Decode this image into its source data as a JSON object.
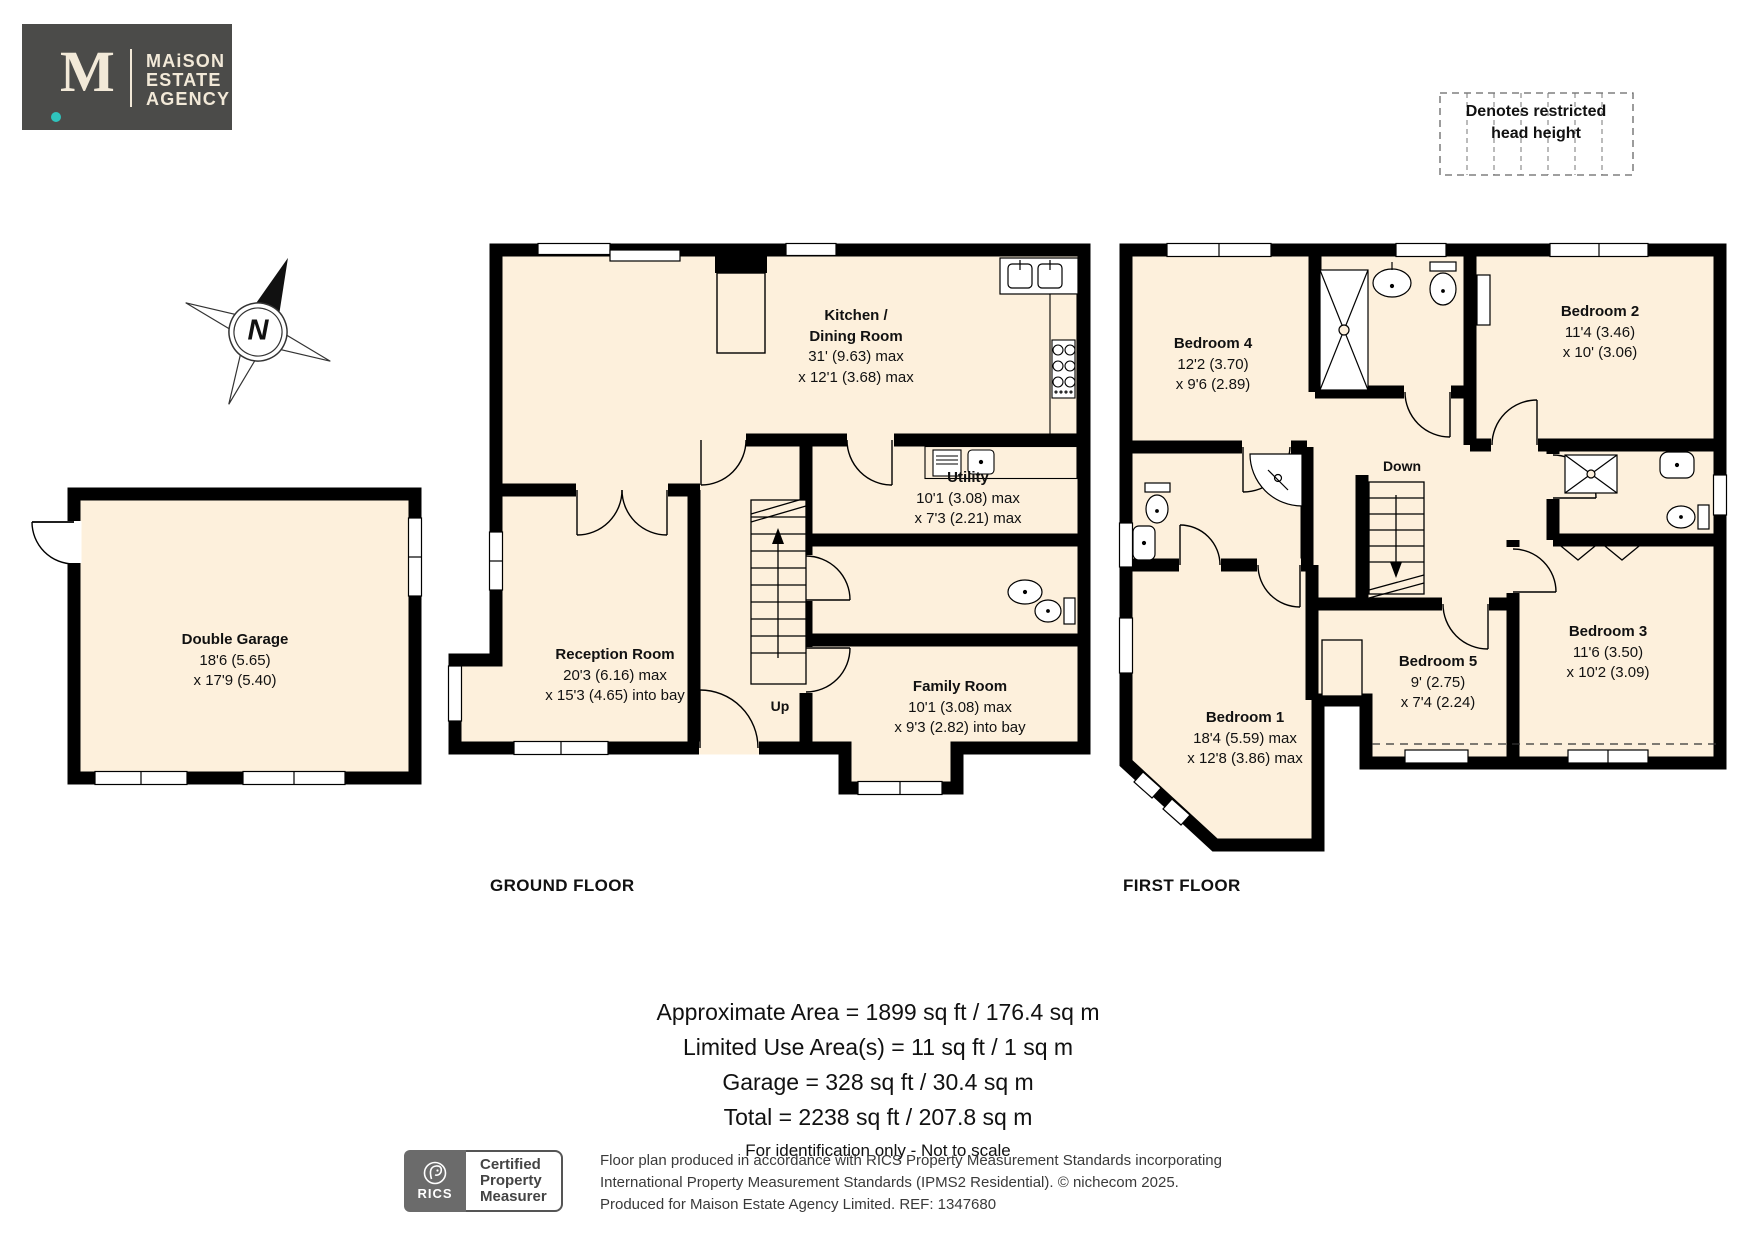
{
  "logo": {
    "monogram": "M",
    "name_lines": [
      "MAiSON",
      "ESTATE",
      "AGENCY"
    ]
  },
  "legend": {
    "line1": "Denotes restricted",
    "line2": "head height"
  },
  "compass": {
    "label": "N"
  },
  "floors": {
    "ground": {
      "label": "GROUND FLOOR",
      "rooms": {
        "garage": {
          "name": "Double Garage",
          "d1": "18'6 (5.65)",
          "d2": "x 17'9 (5.40)"
        },
        "kitchen": {
          "name1": "Kitchen /",
          "name2": "Dining Room",
          "d1": "31' (9.63) max",
          "d2": "x 12'1 (3.68) max"
        },
        "reception": {
          "name": "Reception Room",
          "d1": "20'3 (6.16) max",
          "d2": "x 15'3 (4.65) into bay"
        },
        "utility": {
          "name": "Utility",
          "d1": "10'1 (3.08) max",
          "d2": "x 7'3 (2.21) max"
        },
        "family": {
          "name": "Family Room",
          "d1": "10'1 (3.08) max",
          "d2": "x 9'3 (2.82) into bay"
        },
        "up": "Up"
      }
    },
    "first": {
      "label": "FIRST FLOOR",
      "rooms": {
        "bed1": {
          "name": "Bedroom 1",
          "d1": "18'4 (5.59) max",
          "d2": "x 12'8 (3.86) max"
        },
        "bed2": {
          "name": "Bedroom 2",
          "d1": "11'4 (3.46)",
          "d2": "x 10' (3.06)"
        },
        "bed3": {
          "name": "Bedroom 3",
          "d1": "11'6 (3.50)",
          "d2": "x 10'2 (3.09)"
        },
        "bed4": {
          "name": "Bedroom 4",
          "d1": "12'2 (3.70)",
          "d2": "x 9'6 (2.89)"
        },
        "bed5": {
          "name": "Bedroom 5",
          "d1": "9' (2.75)",
          "d2": "x 7'4 (2.24)"
        },
        "down": "Down"
      }
    }
  },
  "summary": {
    "line1": "Approximate Area = 1899 sq ft / 176.4 sq m",
    "line2": "Limited Use Area(s) = 11 sq ft / 1 sq m",
    "line3": "Garage = 328 sq ft / 30.4 sq m",
    "line4": "Total = 2238 sq ft / 207.8 sq m",
    "disclaimer": "For identification only - Not to scale"
  },
  "certification": {
    "rics_label": "RICS",
    "badge_lines": [
      "Certified",
      "Property",
      "Measurer"
    ],
    "fine_print": [
      "Floor plan produced in accordance with RICS Property Measurement Standards incorporating",
      "International Property Measurement Standards (IPMS2 Residential).   © nichecom 2025.",
      "Produced for Maison Estate Agency Limited.   REF: 1347680"
    ]
  },
  "colors": {
    "room_fill": "#fdf0dc",
    "wall": "#000000",
    "logo_bg": "#4b4b49",
    "logo_text": "#f2e9d8",
    "accent_dot": "#2fc4bd",
    "rics_gray": "#6b6b6b"
  }
}
